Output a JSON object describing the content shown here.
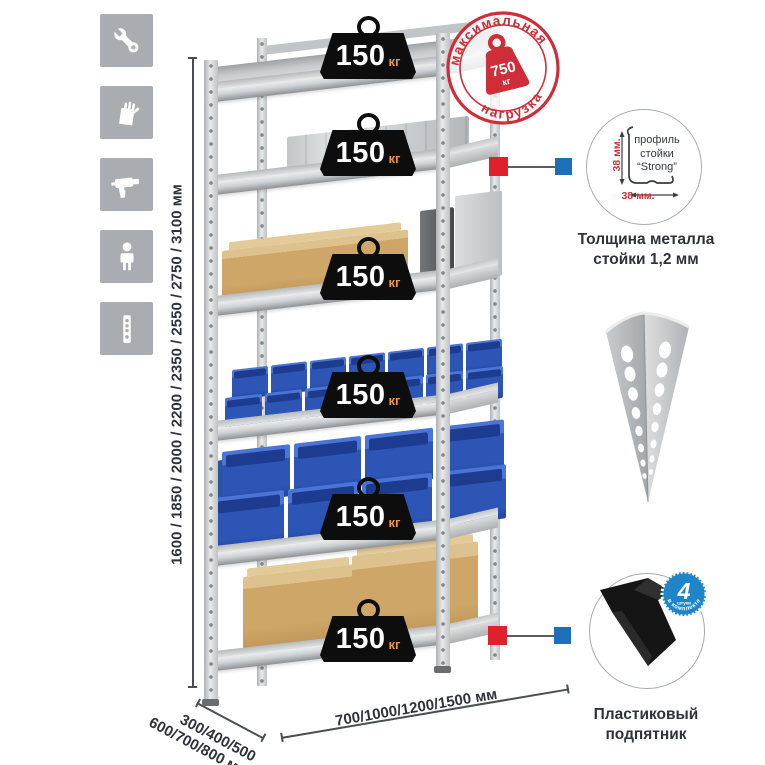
{
  "sidebar_icons": [
    {
      "name": "wrench-icon"
    },
    {
      "name": "gloves-icon"
    },
    {
      "name": "drill-icon"
    },
    {
      "name": "person-icon"
    },
    {
      "name": "rack-post-icon"
    }
  ],
  "dimensions": {
    "height_label": "1600 / 1850 / 2000 / 2200 / 2350 / 2550 / 2750 / 3100 мм",
    "depth_line1": "300/400/500",
    "depth_line2": "600/700/800 мм",
    "width_label": "700/1000/1200/1500 мм"
  },
  "rack": {
    "shelves": [
      {
        "load": "150",
        "unit": "кг",
        "content": "empty-shelf"
      },
      {
        "load": "150",
        "unit": "кг",
        "content": "aluminum-case"
      },
      {
        "load": "150",
        "unit": "кг",
        "content": "cardboard-box-and-metal-cases"
      },
      {
        "load": "150",
        "unit": "кг",
        "content": "small-blue-bins"
      },
      {
        "load": "150",
        "unit": "кг",
        "content": "large-blue-bins"
      },
      {
        "load": "150",
        "unit": "кг",
        "content": "cardboard-boxes"
      }
    ]
  },
  "max_load_stamp": {
    "arc_top": "максимальная",
    "arc_bottom": "нагрузка",
    "value": "750",
    "unit": "кг"
  },
  "profile_detail": {
    "label_line1": "профиль",
    "label_line2": "стойки",
    "label_line3": "“Strong”",
    "dim_vertical": "38 мм.",
    "dim_horizontal": "38 мм.",
    "caption_line1": "Толщина металла",
    "caption_line2": "стойки 1,2 мм"
  },
  "foot_detail": {
    "badge_value": "4",
    "badge_small": "штуки",
    "badge_arc": "в комплекте",
    "caption_line1": "Пластиковый",
    "caption_line2": "подпятник"
  },
  "colors": {
    "stamp_red": "#cf2e38",
    "connector_red": "#e0202a",
    "connector_blue": "#1c6fb8",
    "badge_blue": "#1e86c8",
    "bin_blue": "#2d55b5",
    "cardboard": "#cda668",
    "metal_gray": "#cfd2d4",
    "icon_gray": "#a9adb2",
    "weight_black": "#0d0d0e",
    "kg_orange": "#ee9440",
    "text_dark": "#2f323a"
  }
}
